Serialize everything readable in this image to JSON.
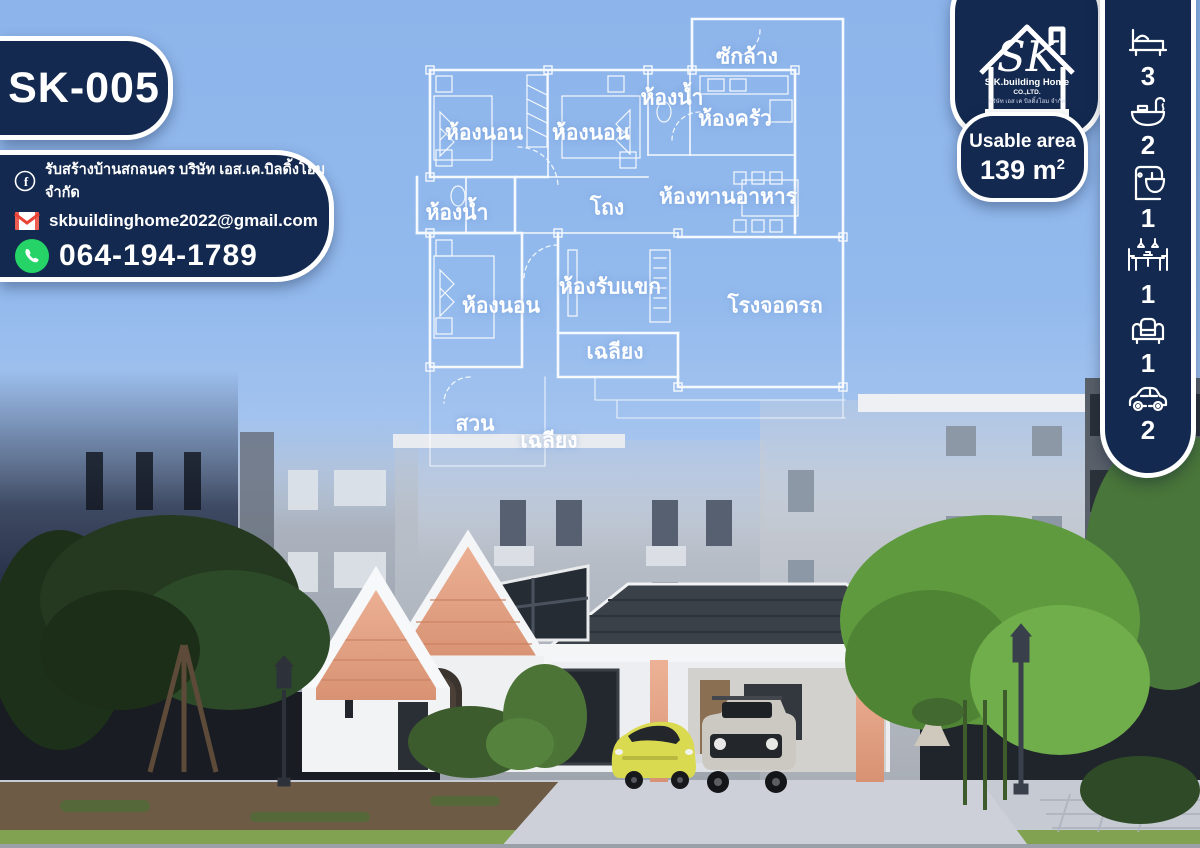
{
  "poster": {
    "model_code": "SK-005",
    "usable_area_label": "Usable area",
    "usable_area_value": "139",
    "usable_area_unit": "m",
    "usable_area_sup": "2"
  },
  "contact": {
    "facebook_text": "รับสร้างบ้านสกลนคร บริษัท เอส.เค.บิลดิ้งโฮม จำกัด",
    "email": "skbuildinghome2022@gmail.com",
    "phone": "064-194-1789"
  },
  "logo": {
    "monogram": "SK",
    "company": "S.K.building Home",
    "suffix": "CO.,LTD.",
    "thai_line": "บริษัท เอส เค บิลดิ้งโฮม จำกัด"
  },
  "amenities": [
    {
      "name": "bedrooms",
      "icon": "bed-icon",
      "count": "3"
    },
    {
      "name": "bathrooms",
      "icon": "bathtub-icon",
      "count": "2"
    },
    {
      "name": "kitchen",
      "icon": "kitchen-mixer-icon",
      "count": "1"
    },
    {
      "name": "dining",
      "icon": "dining-table-icon",
      "count": "1"
    },
    {
      "name": "living",
      "icon": "sofa-icon",
      "count": "1"
    },
    {
      "name": "parking",
      "icon": "car-icon",
      "count": "2"
    }
  ],
  "floor_plan": {
    "rooms": [
      {
        "label": "ซักล้าง",
        "x": 747,
        "y": 57
      },
      {
        "label": "ห้องน้ำ",
        "x": 672,
        "y": 98
      },
      {
        "label": "ห้องครัว",
        "x": 735,
        "y": 119
      },
      {
        "label": "ห้องนอน",
        "x": 484,
        "y": 133
      },
      {
        "label": "ห้องนอน",
        "x": 591,
        "y": 133
      },
      {
        "label": "ห้องน้ำ",
        "x": 457,
        "y": 213
      },
      {
        "label": "โถง",
        "x": 607,
        "y": 208
      },
      {
        "label": "ห้องทานอาหาร",
        "x": 728,
        "y": 197
      },
      {
        "label": "ห้องรับแขก",
        "x": 610,
        "y": 287
      },
      {
        "label": "ห้องนอน",
        "x": 501,
        "y": 306
      },
      {
        "label": "โรงจอดรถ",
        "x": 775,
        "y": 306
      },
      {
        "label": "เฉลียง",
        "x": 615,
        "y": 352
      },
      {
        "label": "สวน",
        "x": 475,
        "y": 424
      },
      {
        "label": "เฉลียง",
        "x": 549,
        "y": 441
      }
    ]
  },
  "colors": {
    "navy": "#13294f",
    "sky": "#90b8ec",
    "plan_line": "#ffffff",
    "whatsapp_green": "#25d366",
    "gmail_red": "#ea4335",
    "brick": "#e2a285",
    "car_yellow": "#d9da4f"
  }
}
